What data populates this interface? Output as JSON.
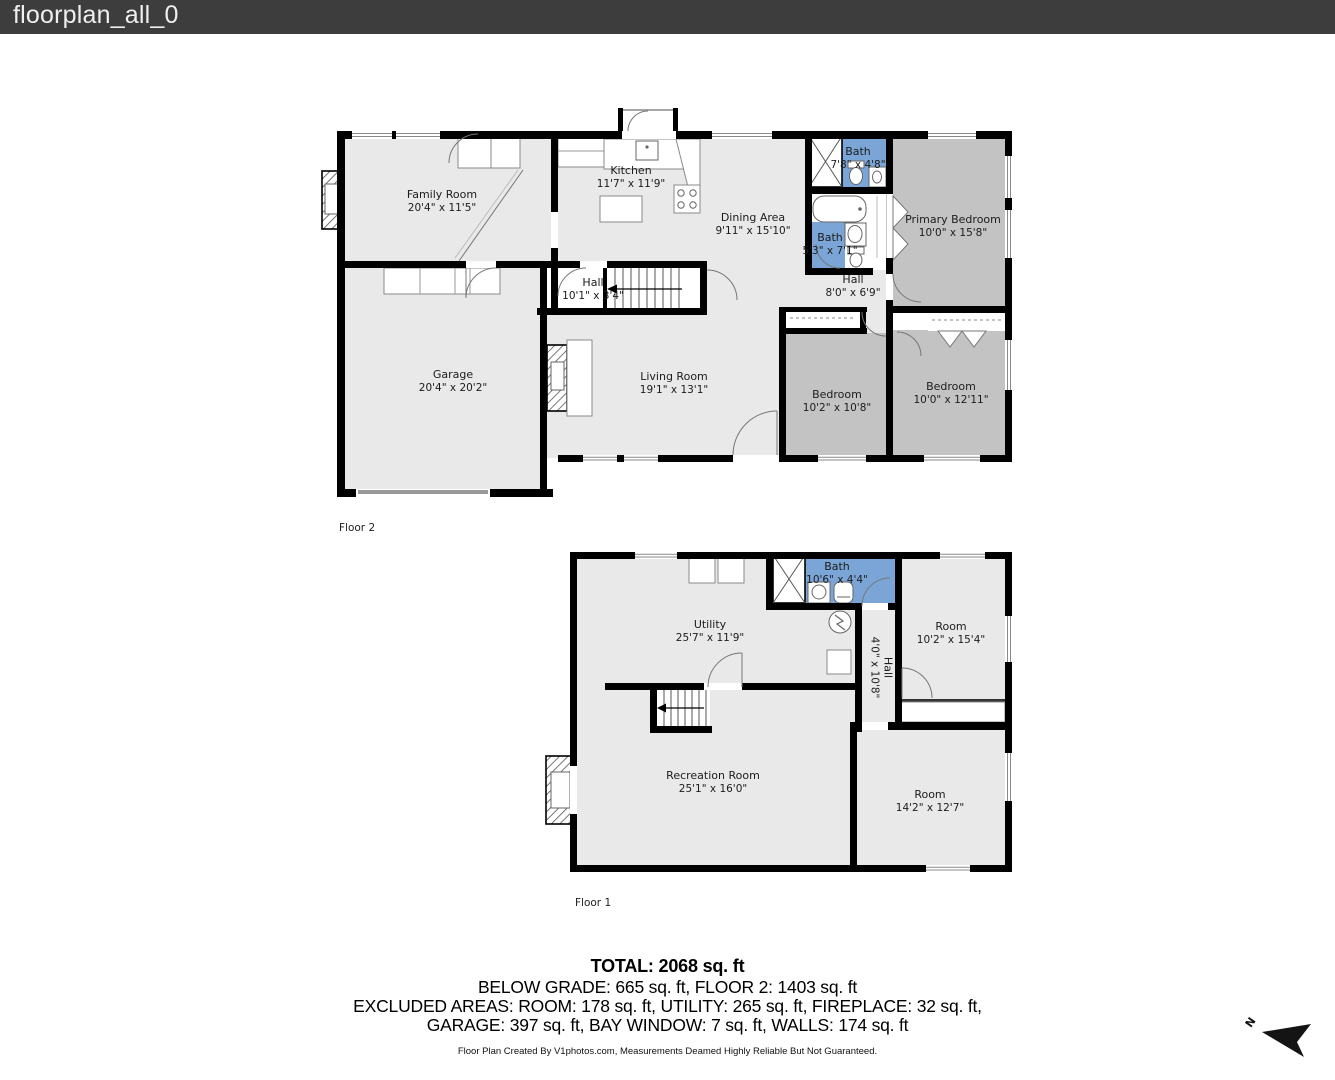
{
  "header": {
    "title": "floorplan_all_0"
  },
  "colors": {
    "header_bg": "#3d3d3d",
    "wall": "#000000",
    "room_light": "#e9e9e9",
    "room_dark": "#c3c3c3",
    "bath_blue": "#7ba5d6"
  },
  "floor2": {
    "caption": "Floor 2",
    "rooms": [
      {
        "name": "Family Room",
        "dims": "20'4\" x 11'5\""
      },
      {
        "name": "Kitchen",
        "dims": "11'7\" x 11'9\""
      },
      {
        "name": "Dining Area",
        "dims": "9'11\" x 15'10\""
      },
      {
        "name": "Bath",
        "dims": "7'8\" x 4'8\""
      },
      {
        "name": "Primary Bedroom",
        "dims": "10'0\" x 15'8\""
      },
      {
        "name": "Bath",
        "dims": "5'3\" x 7'1\""
      },
      {
        "name": "Hall",
        "dims": "8'0\" x 6'9\""
      },
      {
        "name": "Hall",
        "dims": "10'1\" x 3'4\""
      },
      {
        "name": "Garage",
        "dims": "20'4\" x 20'2\""
      },
      {
        "name": "Living Room",
        "dims": "19'1\" x 13'1\""
      },
      {
        "name": "Bedroom",
        "dims": "10'2\" x 10'8\""
      },
      {
        "name": "Bedroom",
        "dims": "10'0\" x 12'11\""
      }
    ]
  },
  "floor1": {
    "caption": "Floor 1",
    "rooms": [
      {
        "name": "Utility",
        "dims": "25'7\" x 11'9\""
      },
      {
        "name": "Bath",
        "dims": "10'6\" x 4'4\""
      },
      {
        "name": "Room",
        "dims": "10'2\" x 15'4\""
      },
      {
        "name": "Hall",
        "dims": "4'0\" x 10'8\""
      },
      {
        "name": "Recreation Room",
        "dims": "25'1\" x 16'0\""
      },
      {
        "name": "Room",
        "dims": "14'2\" x 12'7\""
      }
    ]
  },
  "summary": {
    "total": "TOTAL: 2068 sq. ft",
    "line1": "BELOW GRADE: 665 sq. ft, FLOOR 2: 1403 sq. ft",
    "line2": "EXCLUDED AREAS: ROOM: 178 sq. ft, UTILITY: 265 sq. ft, FIREPLACE: 32 sq. ft,",
    "line3": "GARAGE: 397 sq. ft, BAY WINDOW: 7 sq. ft, WALLS: 174 sq. ft",
    "disclaimer": "Floor Plan Created By V1photos.com, Measurements Deamed Highly Reliable But Not Guaranteed."
  },
  "compass": {
    "label": "N"
  }
}
